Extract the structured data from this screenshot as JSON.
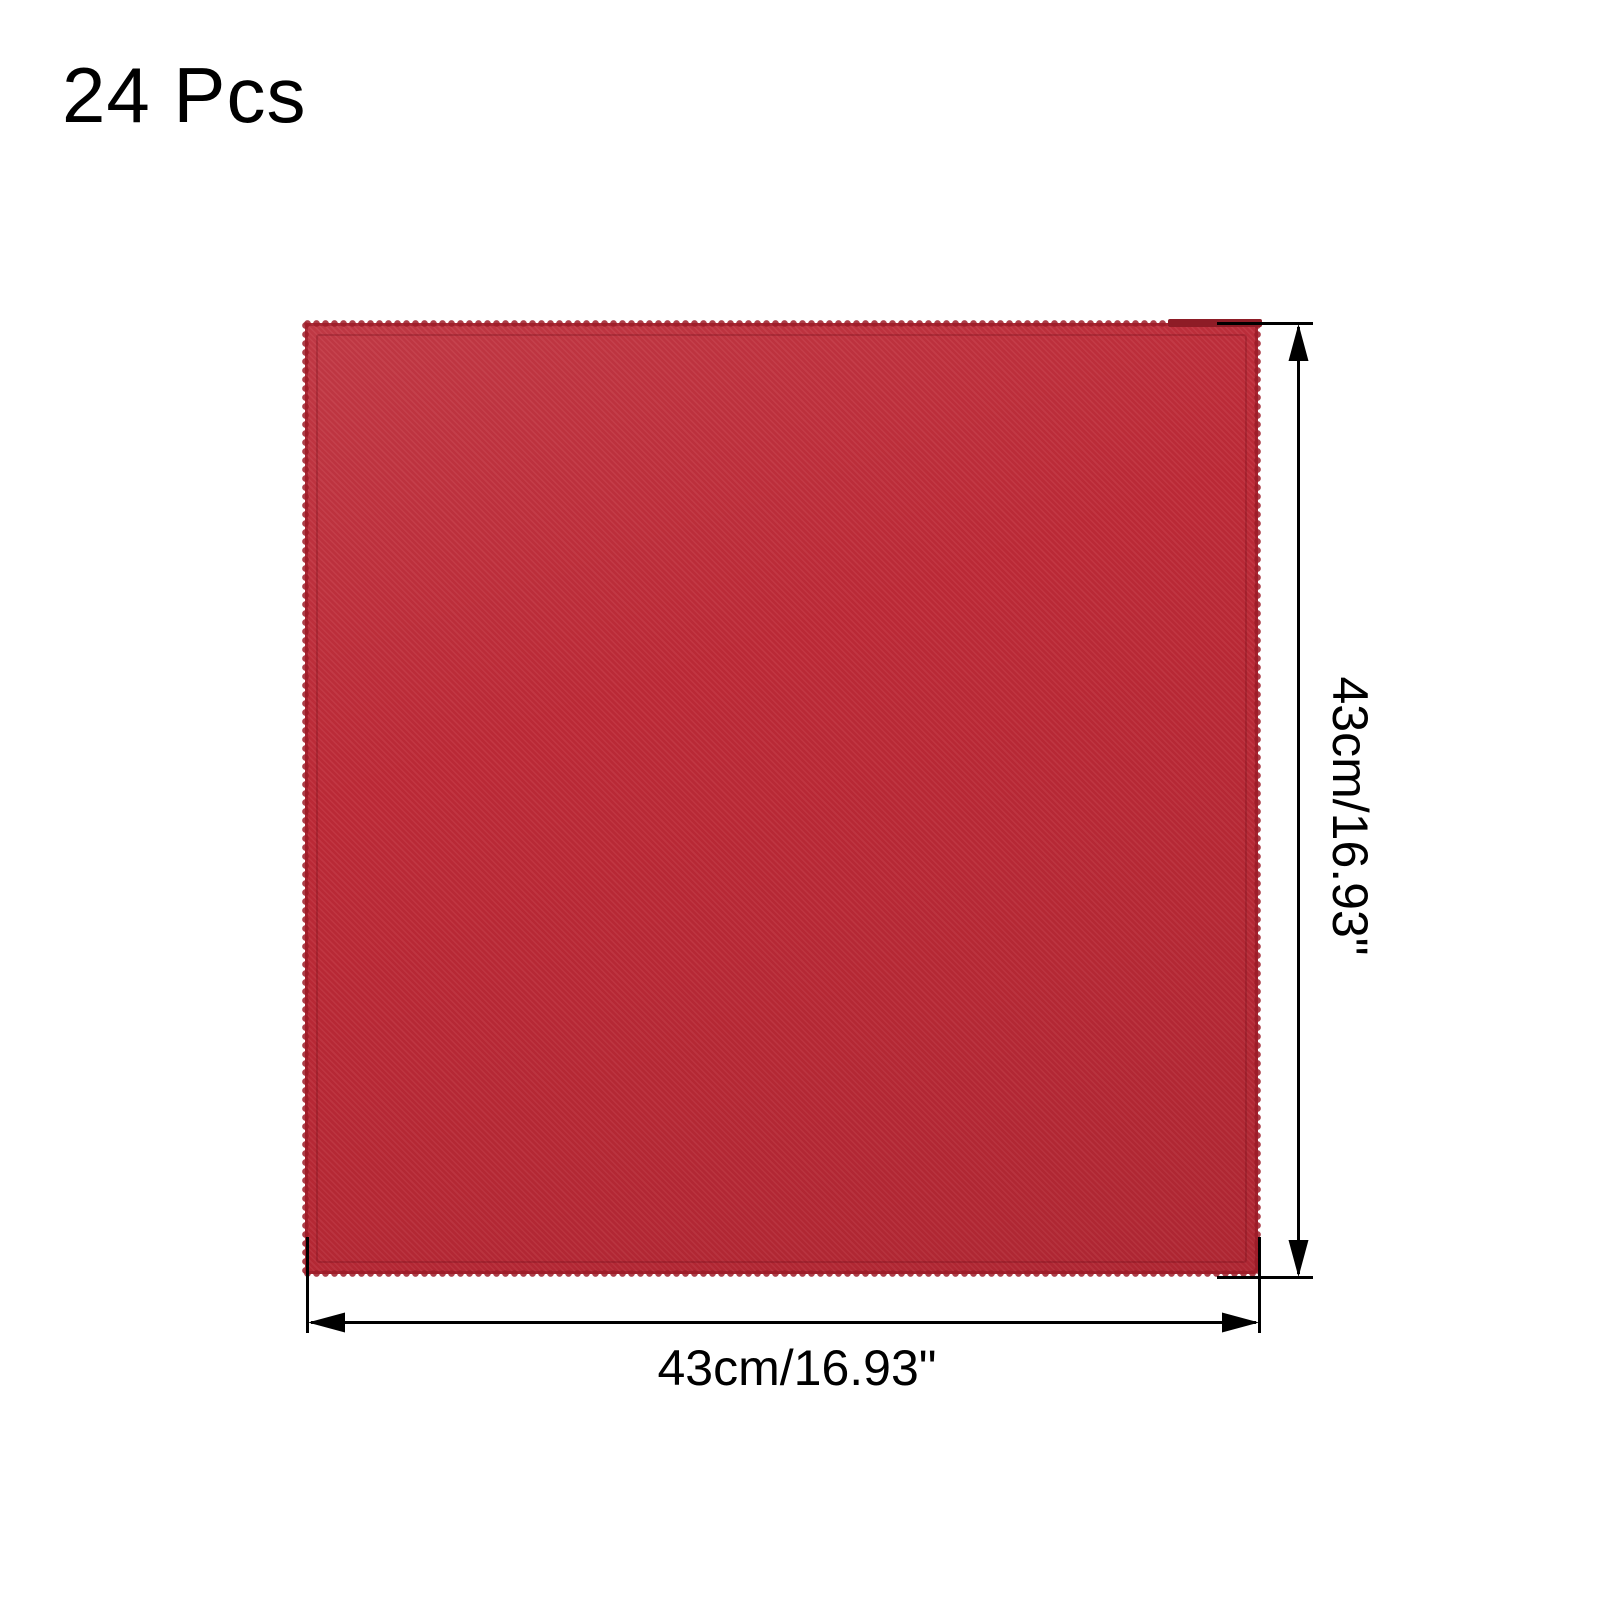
{
  "header": {
    "quantity": "24 Pcs"
  },
  "product": {
    "fabric_color": "#be2a37",
    "hem_color": "#9d1f2b"
  },
  "dimensions": {
    "height_label": "43cm/16.93\"",
    "width_label": "43cm/16.93\"",
    "line_color": "#000000"
  }
}
